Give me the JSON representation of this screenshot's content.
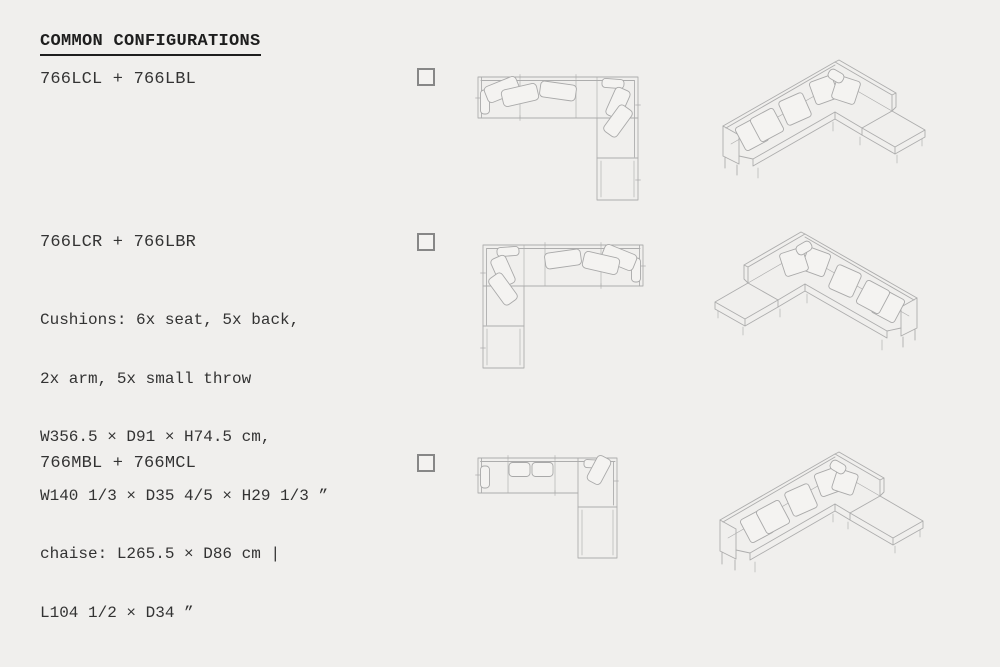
{
  "page": {
    "title": "COMMON CONFIGURATIONS",
    "colors": {
      "background": "#f0efed",
      "text": "#2e2e2e",
      "drawing_line": "#adadad",
      "checkbox_border": "#878787"
    }
  },
  "configurations": [
    {
      "label": "766LCL + 766LBL",
      "checkbox_checked": false,
      "plan_view": "top-view line drawing, corner sofa with chaise lower right",
      "iso_view": "isometric line drawing, corner sofa with chaise on right"
    },
    {
      "label": "766LCR + 766LBR",
      "checkbox_checked": false,
      "details_lines": [
        "Cushions: 6x seat, 5x back,",
        "2x arm, 5x small throw",
        "W356.5 × D91 × H74.5 cm,",
        "W140 1/3 × D35 4/5 × H29 1/3 ”",
        "chaise: L265.5 × D86 cm |",
        "L104 1/2 × D34 ”"
      ],
      "plan_view": "top-view line drawing, mirrored corner sofa with chaise lower left",
      "iso_view": "isometric line drawing, corner sofa with chaise on left"
    },
    {
      "label": "766MBL + 766MCL",
      "checkbox_checked": false,
      "plan_view": "top-view line drawing, sofa with corner unit and chaise below",
      "iso_view": "isometric line drawing, sofa with chaise extension right"
    }
  ]
}
